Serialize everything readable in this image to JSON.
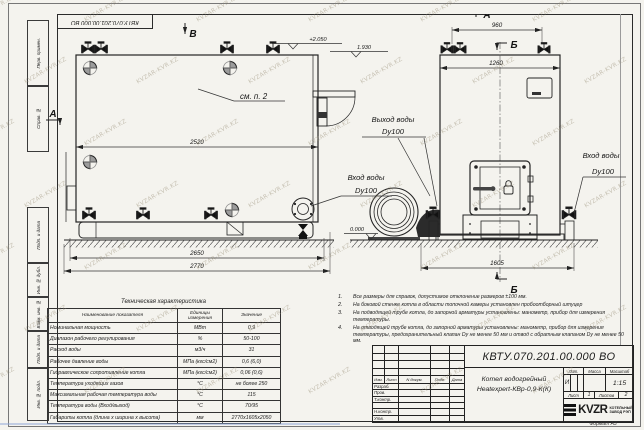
{
  "meta": {
    "watermark": "KVZAR-KVR.KZ",
    "doc_number": "КВТУ.070.201.00.000  ВО",
    "format_label": "Формат",
    "format_value": "А3"
  },
  "margin": {
    "box1": "Перв. примен.",
    "box2": "Справ. №",
    "box3": "Подп. и дата",
    "box4": "Инв. № дубл.",
    "box5": "Взам. инв. №",
    "box6": "Подп. и дата",
    "box7": "Инв. № подл."
  },
  "drawing": {
    "sections": {
      "v": "В",
      "a_top": "А",
      "b_top": "Б",
      "b_bottom": "Б",
      "a_left": "А"
    },
    "elev_top": "+2.050",
    "elev_mid": "1.930",
    "elev_zero": "0.000",
    "see_note": "см. п. 2",
    "dim_2520": "2520",
    "dim_2650": "2650",
    "dim_2770": "2770",
    "dim_960": "960",
    "dim_1260": "1260",
    "dim_1605": "1605",
    "outlet1": "Выход воды",
    "outlet2": "Dy100",
    "inlet_l1": "Вход воды",
    "inlet_l2": "Dy100",
    "inlet_r1": "Вход воды",
    "inlet_r2": "Dy100"
  },
  "tech_table": {
    "title": "Техническая характеристика",
    "headers": [
      "Наименование показателя",
      "Единицы измерения",
      "Значение"
    ],
    "rows": [
      [
        "Номинальная мощность",
        "МВт",
        "0,9"
      ],
      [
        "Диапазон рабочего регулирования",
        "%",
        "50-100"
      ],
      [
        "Расход воды",
        "м3/ч",
        "31"
      ],
      [
        "Рабочее давление воды",
        "МПа (кгс/см2)",
        "0,6 (6,0)"
      ],
      [
        "Гидравлическое сопротивление котла",
        "МПа (кгс/см2)",
        "0,06 (0,6)"
      ],
      [
        "Температура уходящих газов",
        "°С",
        "не более 250"
      ],
      [
        "Максимальная рабочая температура воды",
        "°С",
        "115"
      ],
      [
        "Температура воды (Вход/выход)",
        "°С",
        "70/95"
      ],
      [
        "Габариты котла (длина х ширина х высота)",
        "мм",
        "2770х1605х2050"
      ]
    ]
  },
  "notes": [
    {
      "n": "1.",
      "text": "Все размеры для справок, допустимое отклонение размеров ±100 мм."
    },
    {
      "n": "2.",
      "text": "На боковой стенке котла в области топочной камеры установлен пробоотборный штуцер"
    },
    {
      "n": "3.",
      "text": "На подводящей трубе котла, до запорной арматуры установлены: манометр, прибор для измерения температуры."
    },
    {
      "n": "4.",
      "text": "На отводящей трубе котла, до запорной арматуры установлены: манометр, прибор для измерения температуры, предохранительный клапан Dу не менее 50 мм и отвод с обратным клапаном Dу не менее 50 мм."
    }
  ],
  "title_block": {
    "doc_number": "КВТУ.070.201.00.000  ВО",
    "cols": {
      "izm": "Изм.",
      "list": "Лист",
      "ndok": "N докум.",
      "podp": "Подп.",
      "data": "Дата"
    },
    "rows": {
      "razrab": "Разраб.",
      "prov": "Пров.",
      "tkontr": "Т.контр.",
      "nkontr": "Н.контр.",
      "utv": "Утв."
    },
    "product1": "Котел водогрейный",
    "product2": "Heatexpert-КВр-0,9-К(К)",
    "lit_label": "Лит.",
    "lit_value": "И",
    "mass_label": "Масса",
    "scale_label": "Масштаб",
    "scale_value": "1:15",
    "sheet_label": "Лист",
    "sheet_value": "1",
    "sheets_label": "Листов",
    "sheets_value": "2",
    "brand": "KVZR",
    "brand_line1": "КОТЕЛЬНЫЙ",
    "brand_line2": "ЗАВОД РЭП"
  }
}
